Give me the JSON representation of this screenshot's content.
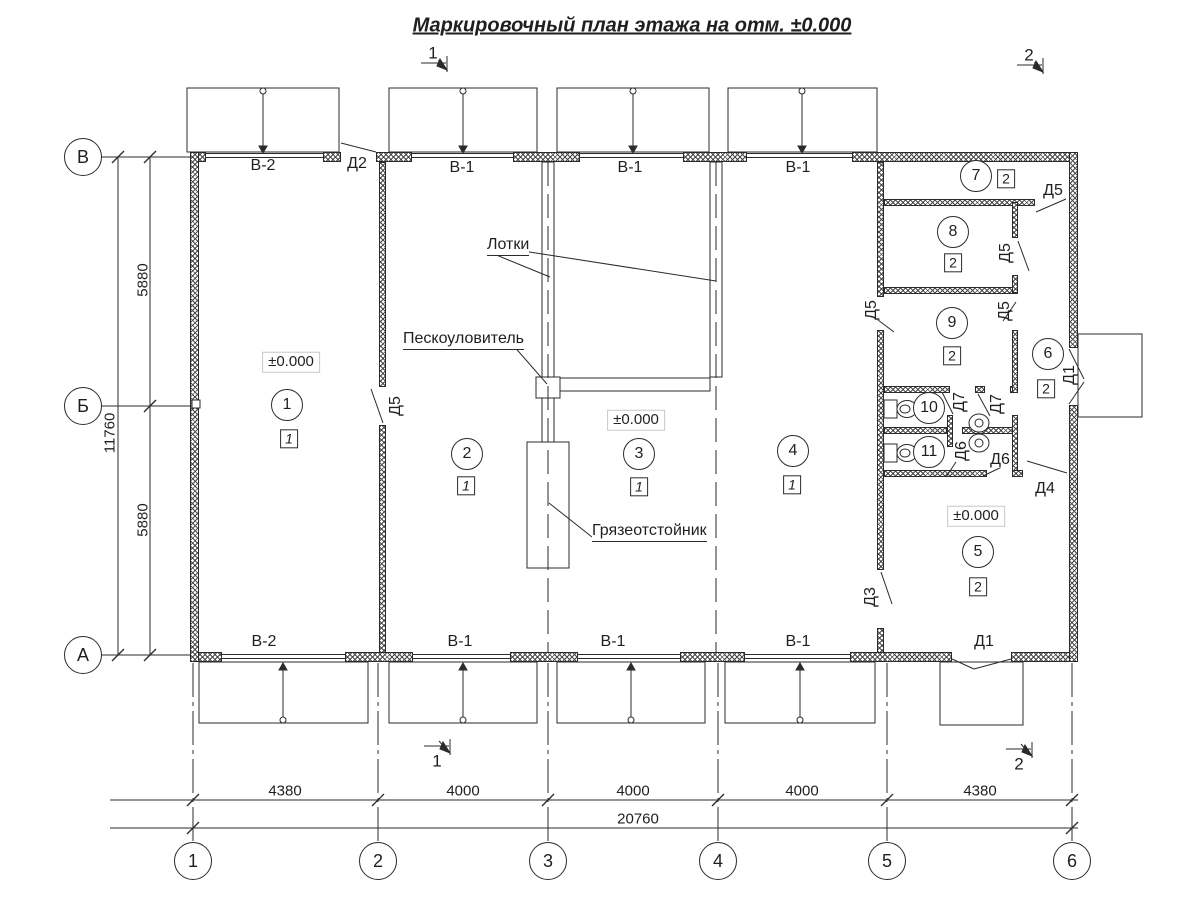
{
  "title": "Маркировочный план этажа на отм. ±0.000",
  "colors": {
    "line": "#2b2b2b",
    "hatch": "#4a4a4a",
    "background": "#ffffff"
  },
  "annotations": {
    "trays": "Лотки",
    "sand_trap": "Пескоуловитель",
    "mud_settler": "Грязеотстойник"
  },
  "elevation_marks": [
    {
      "text": "±0.000",
      "x": 291,
      "y": 362
    },
    {
      "text": "±0.000",
      "x": 636,
      "y": 420
    },
    {
      "text": "±0.000",
      "x": 976,
      "y": 516
    }
  ],
  "rooms": [
    {
      "number": "1",
      "x": 287,
      "y": 405,
      "category": "1",
      "bx": 289,
      "by": 439
    },
    {
      "number": "2",
      "x": 467,
      "y": 454,
      "category": "1",
      "bx": 466,
      "by": 486
    },
    {
      "number": "3",
      "x": 639,
      "y": 454,
      "category": "1",
      "bx": 639,
      "by": 487
    },
    {
      "number": "4",
      "x": 793,
      "y": 451,
      "category": "1",
      "bx": 792,
      "by": 485
    },
    {
      "number": "5",
      "x": 978,
      "y": 552,
      "category": "2",
      "bx": 978,
      "by": 587
    },
    {
      "number": "6",
      "x": 1048,
      "y": 354,
      "category": "2",
      "bx": 1046,
      "by": 389
    },
    {
      "number": "7",
      "x": 976,
      "y": 176,
      "category": "2",
      "bx": 1006,
      "by": 179
    },
    {
      "number": "8",
      "x": 953,
      "y": 232,
      "category": "2",
      "bx": 953,
      "by": 263
    },
    {
      "number": "9",
      "x": 952,
      "y": 323,
      "category": "2",
      "bx": 952,
      "by": 356
    },
    {
      "number": "10",
      "x": 929,
      "y": 408,
      "category": null
    },
    {
      "number": "11",
      "x": 929,
      "y": 452,
      "category": null
    }
  ],
  "door_labels": [
    {
      "text": "Д2",
      "x": 357,
      "y": 164,
      "vertical": false
    },
    {
      "text": "Д5",
      "x": 396,
      "y": 406,
      "vertical": true
    },
    {
      "text": "Д5",
      "x": 1053,
      "y": 191,
      "vertical": false
    },
    {
      "text": "Д5",
      "x": 1006,
      "y": 253,
      "vertical": true
    },
    {
      "text": "Д5",
      "x": 872,
      "y": 310,
      "vertical": true
    },
    {
      "text": "Д5",
      "x": 1005,
      "y": 311,
      "vertical": true
    },
    {
      "text": "Д7",
      "x": 960,
      "y": 402,
      "vertical": true
    },
    {
      "text": "Д7",
      "x": 997,
      "y": 404,
      "vertical": true
    },
    {
      "text": "Д6",
      "x": 962,
      "y": 451,
      "vertical": true
    },
    {
      "text": "Д6",
      "x": 1000,
      "y": 460,
      "vertical": false
    },
    {
      "text": "Д4",
      "x": 1045,
      "y": 489,
      "vertical": false
    },
    {
      "text": "Д1",
      "x": 1070,
      "y": 375,
      "vertical": true
    },
    {
      "text": "Д3",
      "x": 871,
      "y": 597,
      "vertical": true
    },
    {
      "text": "Д1",
      "x": 984,
      "y": 642,
      "vertical": false
    }
  ],
  "window_labels": [
    {
      "text": "В-2",
      "x": 263,
      "y": 166
    },
    {
      "text": "В-1",
      "x": 462,
      "y": 168
    },
    {
      "text": "В-1",
      "x": 630,
      "y": 168
    },
    {
      "text": "В-1",
      "x": 798,
      "y": 168
    },
    {
      "text": "В-2",
      "x": 264,
      "y": 642
    },
    {
      "text": "В-1",
      "x": 460,
      "y": 642
    },
    {
      "text": "В-1",
      "x": 613,
      "y": 642
    },
    {
      "text": "В-1",
      "x": 798,
      "y": 642
    }
  ],
  "grid": {
    "columns": [
      {
        "label": "1",
        "x": 193
      },
      {
        "label": "2",
        "x": 378
      },
      {
        "label": "3",
        "x": 548
      },
      {
        "label": "4",
        "x": 718
      },
      {
        "label": "5",
        "x": 887
      },
      {
        "label": "6",
        "x": 1072
      }
    ],
    "rows": [
      {
        "label": "В",
        "y": 157
      },
      {
        "label": "Б",
        "y": 406
      },
      {
        "label": "А",
        "y": 655
      }
    ]
  },
  "dimensions": {
    "bottom_segments": [
      {
        "text": "4380",
        "x": 285
      },
      {
        "text": "4000",
        "x": 463
      },
      {
        "text": "4000",
        "x": 633
      },
      {
        "text": "4000",
        "x": 802
      },
      {
        "text": "4380",
        "x": 980
      }
    ],
    "bottom_total": {
      "text": "20760",
      "x": 638,
      "y": 819
    },
    "left_segments": [
      {
        "text": "5880",
        "y": 280
      },
      {
        "text": "5880",
        "y": 520
      }
    ],
    "left_total": {
      "text": "11760",
      "y": 433
    }
  },
  "section_marks": [
    {
      "text": "1",
      "x": 433,
      "y": 53
    },
    {
      "text": "2",
      "x": 1029,
      "y": 55
    },
    {
      "text": "1",
      "x": 437,
      "y": 761
    },
    {
      "text": "2",
      "x": 1019,
      "y": 764
    }
  ]
}
